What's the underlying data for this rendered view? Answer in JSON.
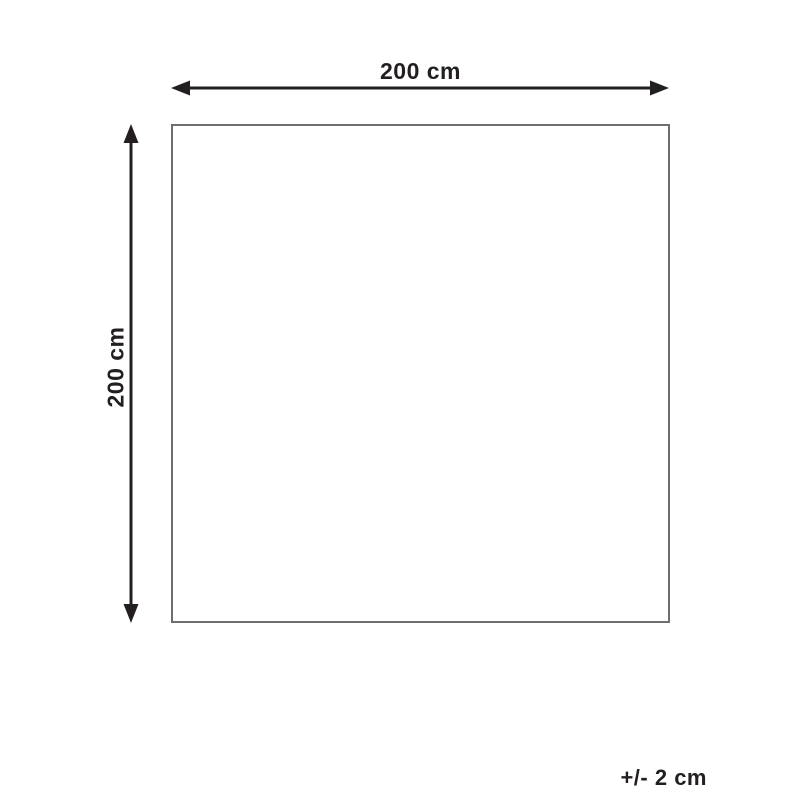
{
  "diagram": {
    "type": "product-dimension-diagram",
    "shape": "square",
    "width_label": "200 cm",
    "height_label": "200 cm",
    "tolerance_label": "+/- 2 cm",
    "dimensions": {
      "width_value": "200 cm",
      "height_value": "200 cm",
      "tolerance_value": "+/- 2 cm"
    },
    "colors": {
      "arrow": "#231f20",
      "outline": "#6d6e71",
      "background": "#ffffff"
    }
  }
}
